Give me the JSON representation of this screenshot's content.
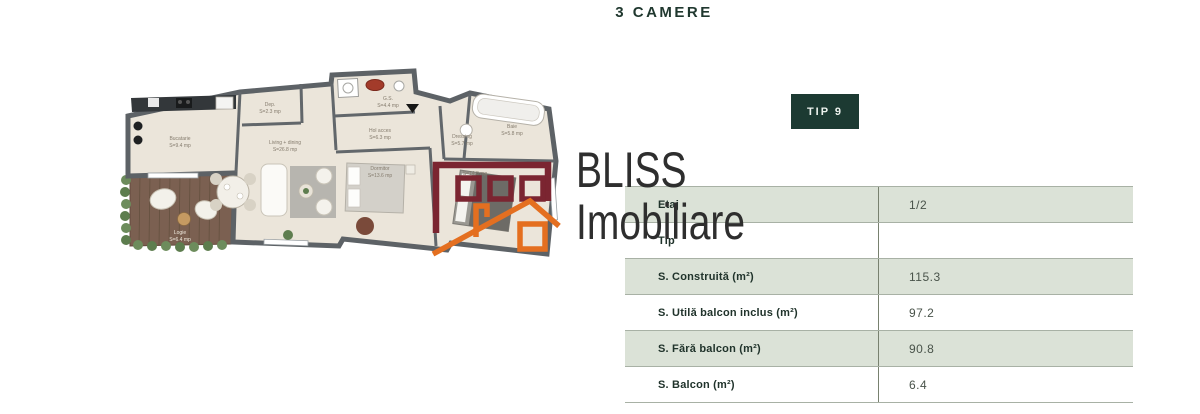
{
  "page": {
    "title": "3 CAMERE"
  },
  "badge": {
    "label": "TIP 9"
  },
  "watermark": {
    "line1": "BLISS",
    "line2": "Imobiliare",
    "maroon": "#7b2531",
    "orange": "#e46f20",
    "text_color": "#2e2e2e"
  },
  "table": {
    "rows": [
      {
        "label": "Etaj",
        "value": "1/2"
      },
      {
        "label": "Tip",
        "value": ""
      },
      {
        "label": "S. Construită (m²)",
        "value": "115.3"
      },
      {
        "label": "S. Utilă balcon inclus (m²)",
        "value": "97.2"
      },
      {
        "label": "S. Fără balcon (m²)",
        "value": "90.8"
      },
      {
        "label": "S. Balcon (m²)",
        "value": "6.4"
      }
    ],
    "row_green": "#dbe2d7",
    "row_white": "#ffffff"
  },
  "floorplan": {
    "rooms": [
      {
        "name": "Bucatarie",
        "area": "S=9.4 mp"
      },
      {
        "name": "Dep.",
        "area": "S=2.3 mp"
      },
      {
        "name": "Living + dining",
        "area": "S=26.8 mp"
      },
      {
        "name": "G.S.",
        "area": "S=4.4 mp"
      },
      {
        "name": "Hol acces",
        "area": "S=6.3 mp"
      },
      {
        "name": "Dormitor",
        "area": "S=13.6 mp"
      },
      {
        "name": "Dressing",
        "area": "S=5.7 mp"
      },
      {
        "name": "Baie",
        "area": "S=5.8 mp"
      },
      {
        "name": "Dormitor matrimonial",
        "area": "S=14.8 mp"
      },
      {
        "name": "Logie",
        "area": "S=6.4 mp"
      }
    ],
    "wall_color": "#5d6266",
    "floor_color": "#ebe5da",
    "terrace_color": "#7b6051"
  },
  "colors": {
    "title": "#20382f",
    "badge_bg": "#1c3a32",
    "badge_text": "#edf2ee"
  }
}
